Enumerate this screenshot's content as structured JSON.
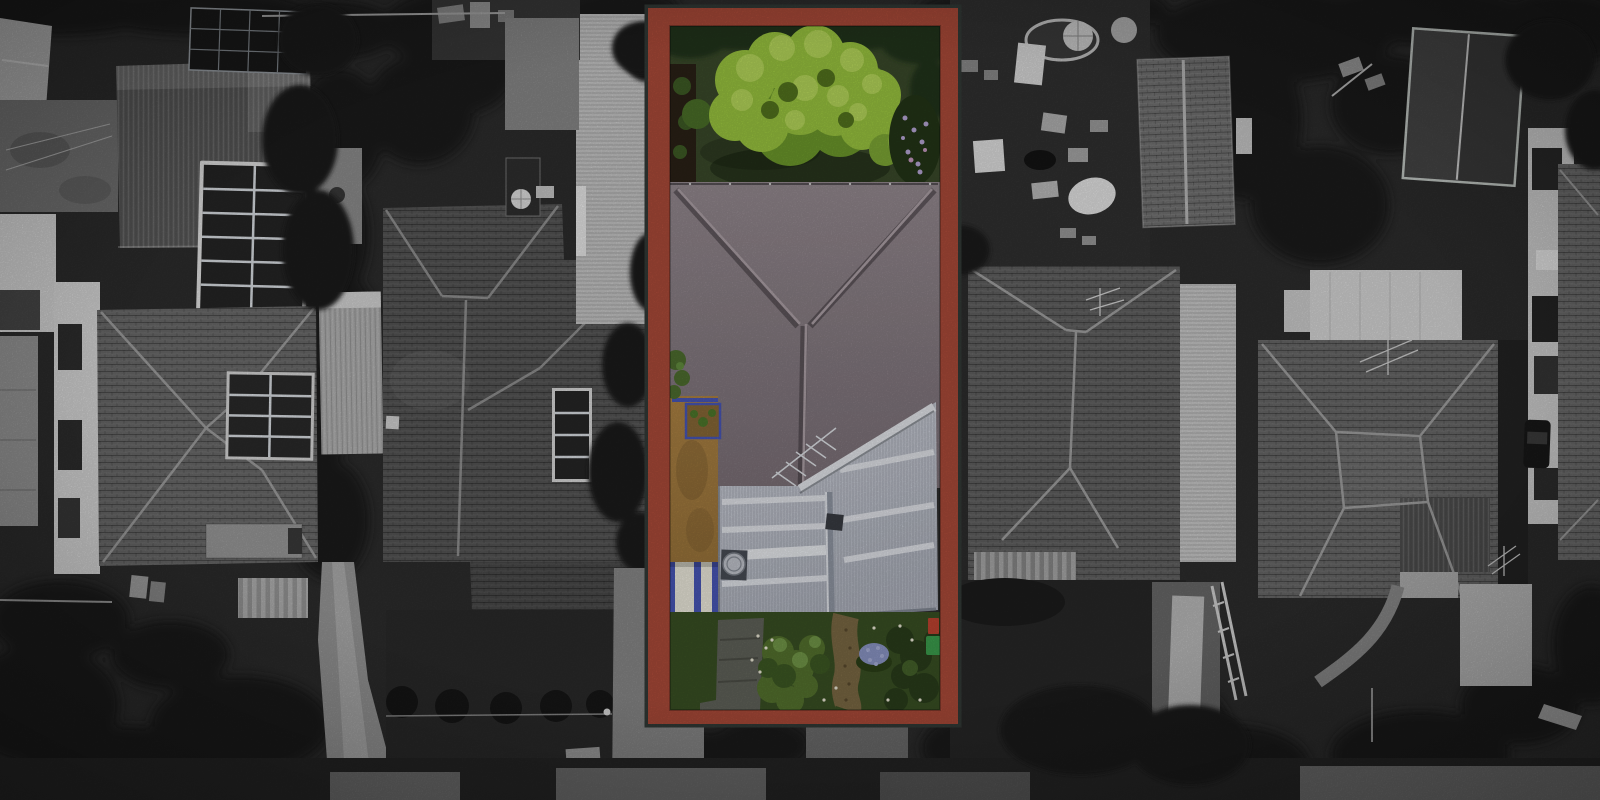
{
  "image": {
    "type": "aerial-drone-photograph",
    "style": "surroundings desaturated to black-and-white; featured lot shown in full colour inside a terracotta border",
    "description": "Top-down aerial photograph of a suburban block. A narrow rectangular property in the centre is highlighted in colour and outlined with a thick terracotta-red border: green backyard lawn with a large bright tree, grey hip-roofed house, tan side driveway with a white awning with blue stripes, pale corrugated rear roof, and a front garden with shrubs, a brown path and purple flowers. All neighbouring houses, solar panels, carports, driveways, backyards and the street are desaturated greyscale."
  },
  "highlighted_property": {
    "border_color": "#AD4C3A",
    "border_ring_color": "#343B38",
    "features": [
      "backyard lawn",
      "large bright green tree",
      "garden bed",
      "purple flowering shrub",
      "grey-mauve hip roof with Y ridge",
      "tv antenna",
      "tan side driveway",
      "blue-framed garden box",
      "white awning with blue stripes",
      "pale corrugated rear roof",
      "whirlybird roof vent",
      "front garden shrubs",
      "brown garden path",
      "purple flower patch",
      "red and green bins"
    ]
  },
  "surroundings": {
    "greyscale": true,
    "features": [
      "corrugated-roof house with rooftop solar arrays",
      "tiled hip-roof house with 8-panel solar array",
      "ribbed carport roofs",
      "dark tiled house with vertical solar strip",
      "cluttered backyard with trampoline, umbrellas and boxes",
      "gabled tile roof",
      "dark shed with light ridge",
      "two large tiled hip-roof houses",
      "white building with dark windows",
      "parked car",
      "concrete driveways",
      "front paths",
      "street and footpath",
      "trees and hedges",
      "wheelie bins",
      "clothesline"
    ]
  },
  "colors": {
    "frame_red": "#AD4C3A",
    "frame_ring": "#343B38",
    "lawn_green": "#3B4B2B",
    "foliage_dark": "#22351A",
    "tree_green": "#9CC740",
    "tree_green_light": "#BCDC60",
    "tree_green_dark": "#6E9A2C",
    "roof_mauve": "#8D8289",
    "white_roof": "#C7CBD4",
    "drive_tan": "#A87E41",
    "awning_white": "#F0EDE0",
    "awning_blue": "#4A58BA",
    "garden_green": "#55742F",
    "garden_green_dark": "#31471E",
    "path_brown": "#7C6A45",
    "flower_purple": "#8D97C8",
    "accent_red_bin": "#C24532",
    "accent_green_bin": "#3DA04E",
    "gs_base": "#2E2E2E",
    "gs_shadow": "#1C1C1C",
    "gs_roof_light": "#B7B7B7",
    "gs_roof_white": "#DCDCDC",
    "gs_concrete": "#8F8F8F"
  }
}
